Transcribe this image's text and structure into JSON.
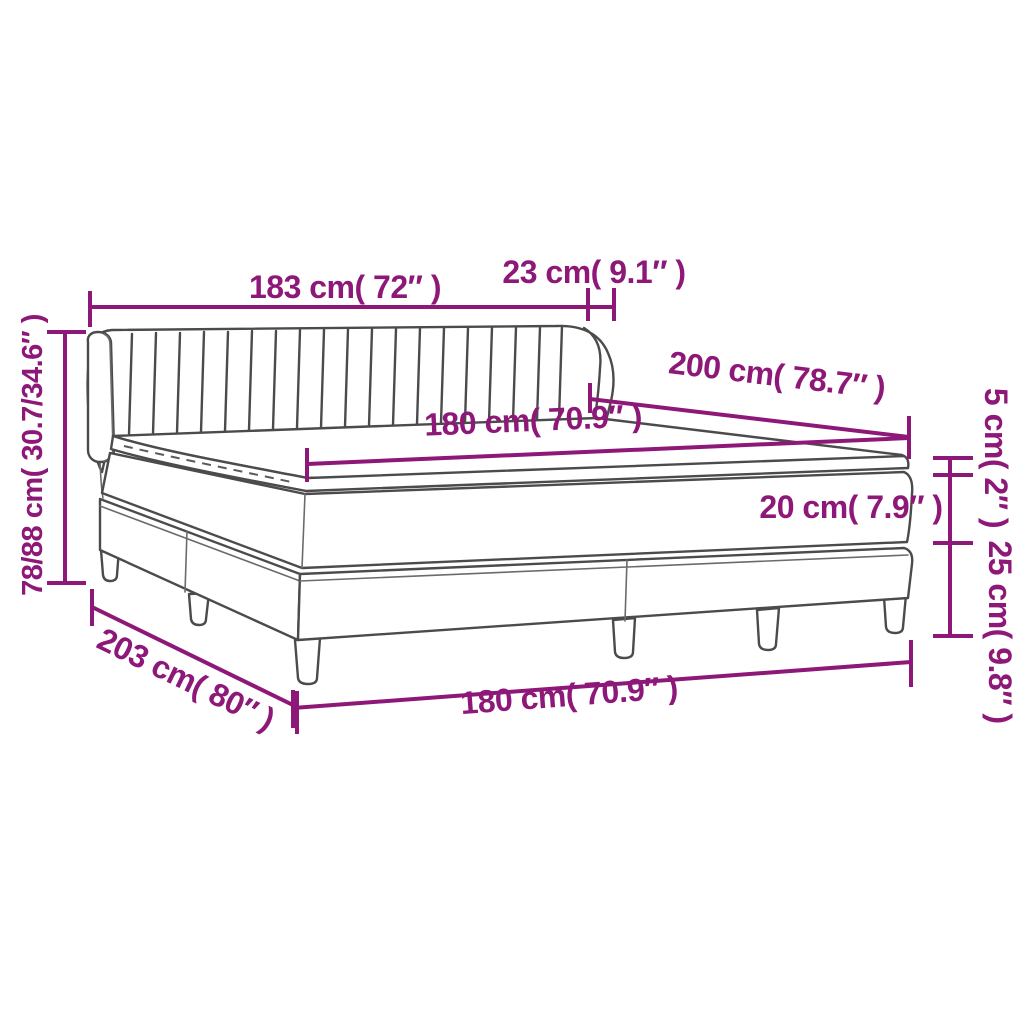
{
  "diagram": {
    "title": "box spring bed dimension diagram",
    "accent_color": "#8d1878",
    "outline_color": "#4b4b4b",
    "background_color": "#ffffff",
    "labels": {
      "headboard_width": "183 cm( 72″ )",
      "headboard_depth": "23 cm( 9.1″ )",
      "headboard_height": "78/88 cm( 30.7/34.6″ )",
      "bed_length": "200 cm( 78.7″ )",
      "mattress_width": "180 cm( 70.9″ )",
      "topper_thickness": "5 cm( 2″ )",
      "mattress_thickness": "20 cm( 7.9″ )",
      "base_height": "25 cm( 9.8″ )",
      "total_length": "203 cm( 80″ )",
      "base_width": "180 cm( 70.9″ )"
    }
  }
}
